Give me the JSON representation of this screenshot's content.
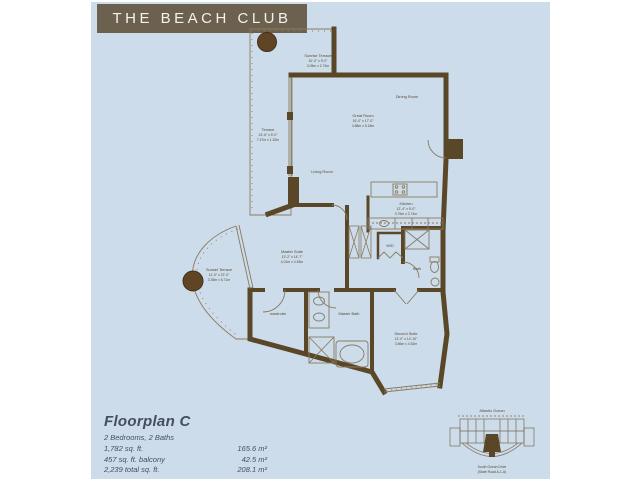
{
  "header": {
    "title": "THE BEACH CLUB"
  },
  "colors": {
    "page_bg": "#ccdcea",
    "title_bg": "#6c604e",
    "wall_brown": "#5a4728",
    "thin_line": "#8a7a5f",
    "detail_text": "#454e61"
  },
  "plan": {
    "rooms": {
      "sunrise_terrace": {
        "name": "Sunrise Terrace",
        "dims_ft": "10'-0\" x 9'-0\"",
        "dims_m": "3.05m x 2.74m"
      },
      "terrace": {
        "name": "Terrace",
        "dims_ft": "24'-6\" x 5'-0\"",
        "dims_m": "7.47m x 1.52m"
      },
      "dining_room": {
        "name": "Dining Room"
      },
      "great_room": {
        "name": "Great Room",
        "dims_ft": "16'-0\" x 17'-0\"",
        "dims_m": "4.88m x 5.18m"
      },
      "living_room": {
        "name": "Living Room"
      },
      "kitchen": {
        "name": "Kitchen",
        "dims_ft": "12'-4\" x 9'-0\"",
        "dims_m": "3.76m x 2.74m"
      },
      "master_suite": {
        "name": "Master Suite",
        "dims_ft": "13'-2\" x 14'-7\"",
        "dims_m": "4.01m x 4.45m"
      },
      "sunset_terrace": {
        "name": "Sunset Terrace",
        "dims_ft": "11'-0\" x 22'-0\"",
        "dims_m": "3.35m x 6.71m"
      },
      "wardrobe": {
        "name": "wardrobe"
      },
      "master_bath": {
        "name": "Master Bath"
      },
      "second_suite": {
        "name": "Second Suite",
        "dims_ft": "12'-0\" x 14'-10\"",
        "dims_m": "3.66m x 4.52m"
      },
      "bath": {
        "name": "Bath"
      },
      "wd": {
        "name": "W/D"
      }
    },
    "keyplan": {
      "top_label": "Atlantic Ocean",
      "bottom_label_1": "South Ocean Drive",
      "bottom_label_2": "(State Road A-1-A)"
    }
  },
  "details": {
    "plan_name": "Floorplan C",
    "bedrooms_baths": "2 Bedrooms, 2 Baths",
    "rows": [
      {
        "imperial": "1,782 sq. ft.",
        "metric": "165.6 m²"
      },
      {
        "imperial": "457 sq. ft. balcony",
        "metric": "42.5 m²"
      },
      {
        "imperial": "2,239 total sq. ft.",
        "metric": "208.1 m²"
      }
    ]
  }
}
